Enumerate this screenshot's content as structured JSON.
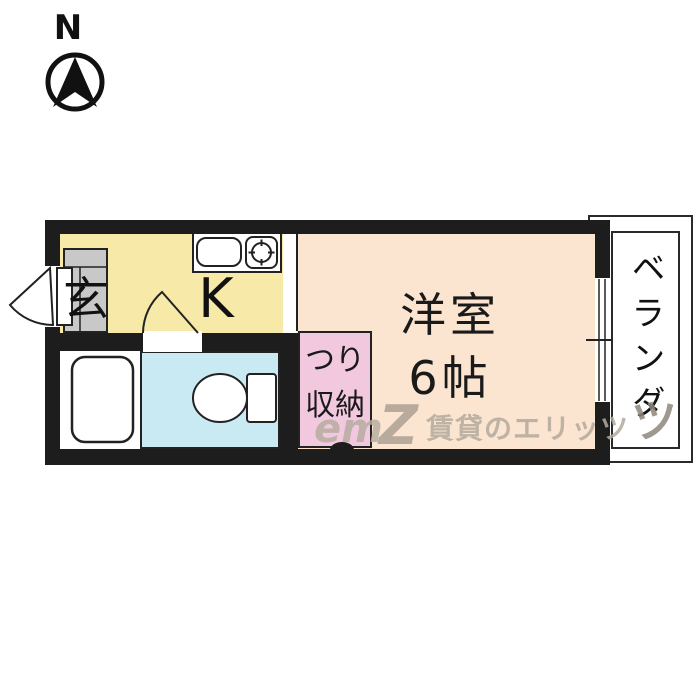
{
  "compass": {
    "north_label": "N"
  },
  "floor_plan": {
    "entrance": {
      "label": "玄"
    },
    "kitchen": {
      "label": "K"
    },
    "western_room": {
      "name": "洋室",
      "size": "6帖"
    },
    "storage": {
      "line1": "つり",
      "line2": "収納"
    },
    "veranda": {
      "label": "ベランダ"
    }
  },
  "watermark": {
    "logo_script": "em",
    "logo_z": "Z",
    "text": "賃貸のエリッツ",
    "extra": "ツ"
  },
  "colors": {
    "wall": "#1d1d1d",
    "kitchen": "#F7E9A8",
    "western_room": "#FBE5D1",
    "storage": "#F2C8DF",
    "bathroom": "#C9EAF3",
    "entrance_floor": "#C8C8C8",
    "watermark": "#b3aa9d"
  }
}
